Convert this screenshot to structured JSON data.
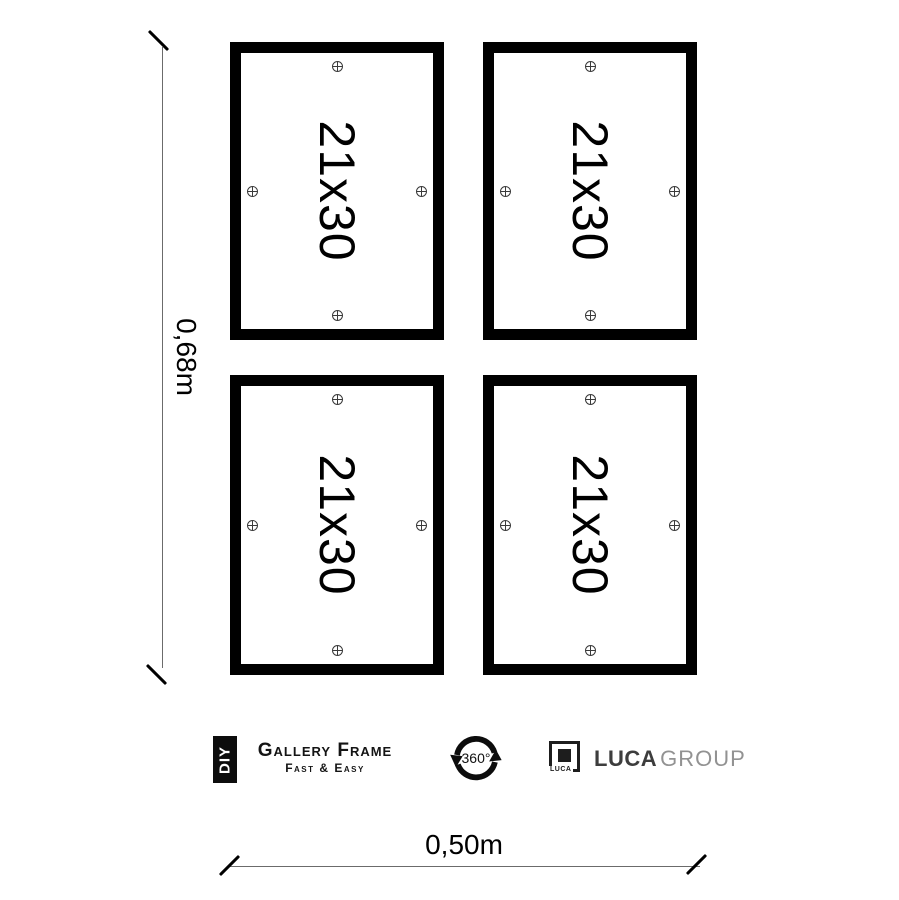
{
  "canvas": {
    "background": "#ffffff"
  },
  "frames": {
    "border_color": "#000000",
    "marker_icon": "crosshair-circle",
    "items": [
      {
        "position": "top-left",
        "label": "21x30"
      },
      {
        "position": "top-right",
        "label": "21x30"
      },
      {
        "position": "bottom-left",
        "label": "21x30"
      },
      {
        "position": "bottom-right",
        "label": "21x30"
      }
    ]
  },
  "dimensions": {
    "line_color": "#6b6b6b",
    "height": {
      "label": "0,68m"
    },
    "width": {
      "label": "0,50m"
    }
  },
  "footer": {
    "diy_badge": {
      "label": "DIY"
    },
    "brand": {
      "title": "Gallery Frame",
      "subtitle": "Fast & Easy"
    },
    "rotation_badge": {
      "label": "360°"
    },
    "luca": {
      "logo_text": "LUCA",
      "name": "LUCA",
      "suffix": "GROUP",
      "name_color": "#3d3d3d",
      "suffix_color": "#929292"
    }
  }
}
